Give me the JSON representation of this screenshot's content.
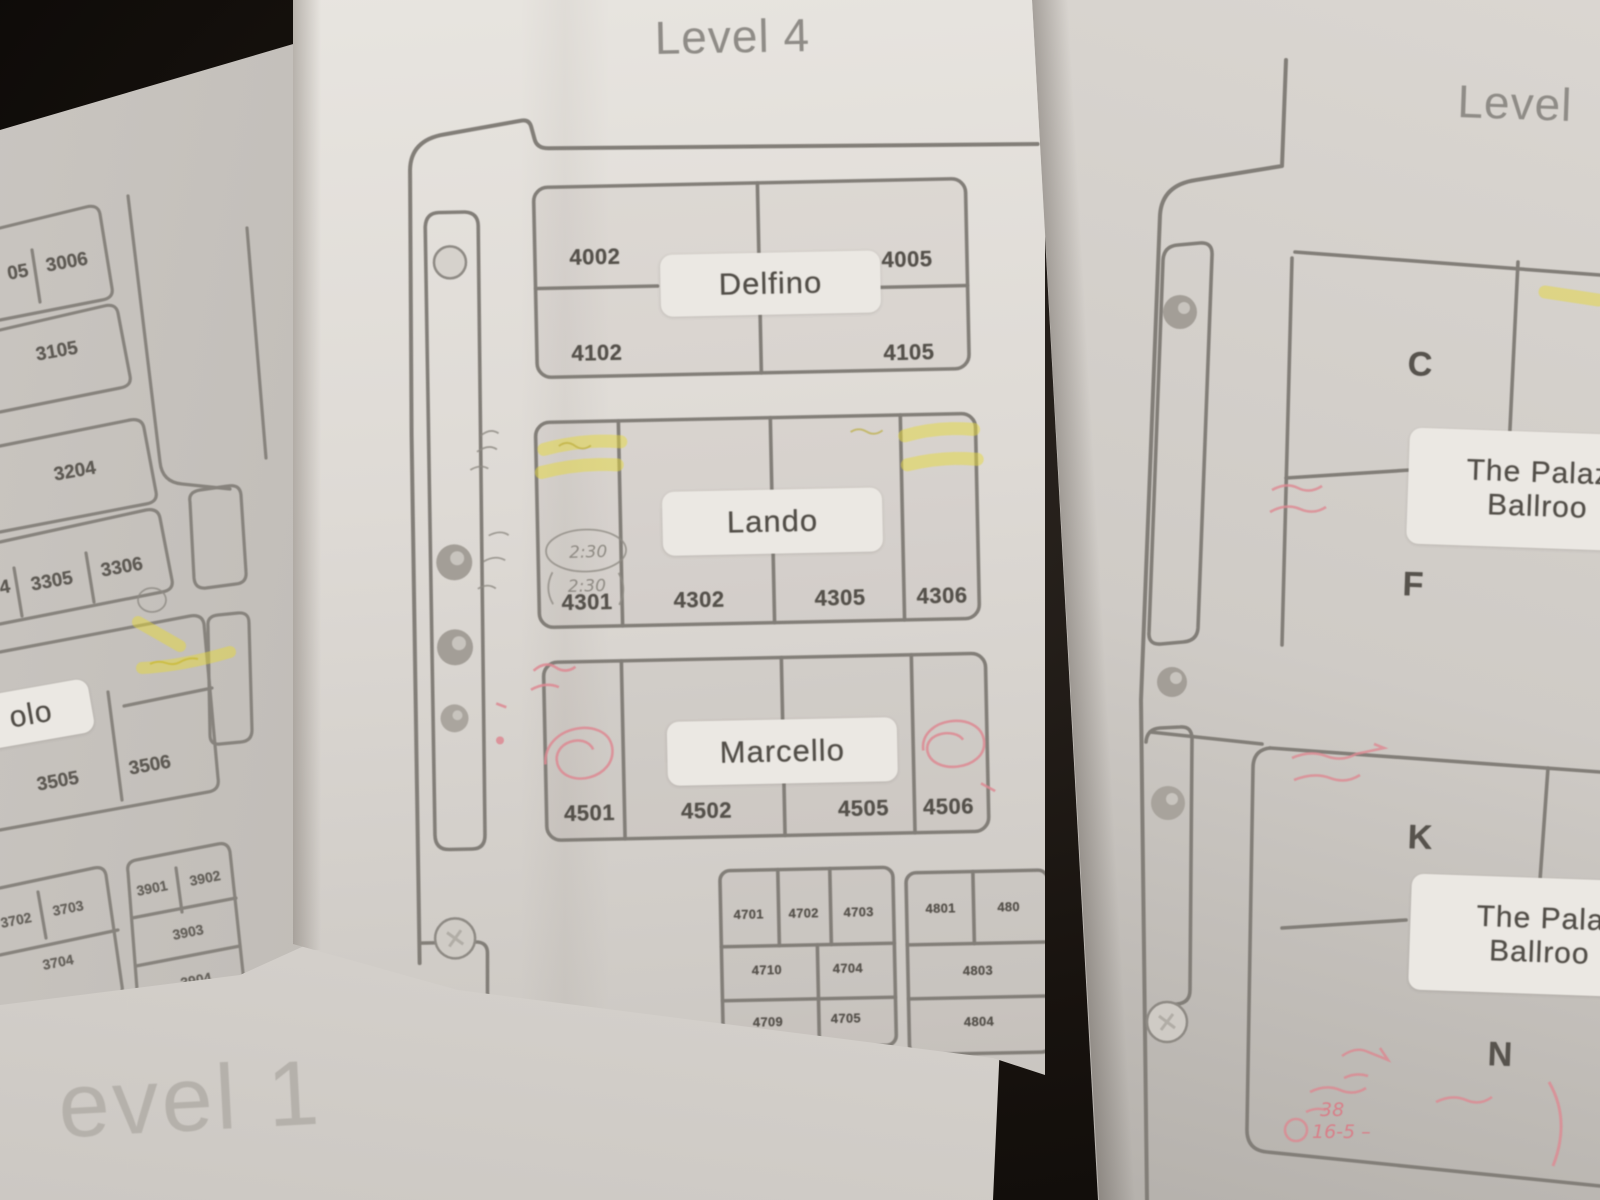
{
  "left_sheet": {
    "rooms": {
      "r3005_partial": "05",
      "r3006": "3006",
      "r3105": "3105",
      "r3204": "3204",
      "r3304_partial": "4",
      "r3305": "3305",
      "r3306": "3306",
      "name_partial": "olo",
      "r3505": "3505",
      "r3506": "3506",
      "r3702": "3702",
      "r3703": "3703",
      "r3704": "3704",
      "r3901": "3901",
      "r3902": "3902",
      "r3903": "3903",
      "r3904": "3904"
    }
  },
  "level1_sheet": {
    "title_partial": "evel 1"
  },
  "center_sheet": {
    "title": "Level 4",
    "delfino": {
      "name": "Delfino",
      "rooms": [
        "4002",
        "4005",
        "4102",
        "4105"
      ]
    },
    "lando": {
      "name": "Lando",
      "rooms": [
        "4301",
        "4302",
        "4305",
        "4306"
      ]
    },
    "marcello": {
      "name": "Marcello",
      "rooms": [
        "4501",
        "4502",
        "4505",
        "4506"
      ]
    },
    "small_rooms_left": [
      "4701",
      "4702",
      "4703",
      "4710",
      "4704",
      "4709",
      "4705"
    ],
    "small_rooms_right": [
      "4801",
      "480",
      "4803",
      "4804"
    ],
    "annotations": {
      "pencil_circled_1": "2:30",
      "pencil_circled_2": "2:30"
    }
  },
  "right_sheet": {
    "title_partial": "Level",
    "rooms": [
      "C",
      "F",
      "K",
      "N"
    ],
    "ballroom_top": {
      "line1": "The Palaz",
      "line2": "Ballroo"
    },
    "ballroom_bottom": {
      "line1": "The Pala",
      "line2": "Ballroo"
    },
    "annotations": {
      "red_bottom_1": "16-5 –",
      "red_bottom_2": "38"
    }
  },
  "colors": {
    "plan_line": "#827e78",
    "paper": "#ddd9d4",
    "highlighter": "#e6d83e",
    "red_pen": "#dd8992",
    "pencil": "#8f8b84"
  }
}
